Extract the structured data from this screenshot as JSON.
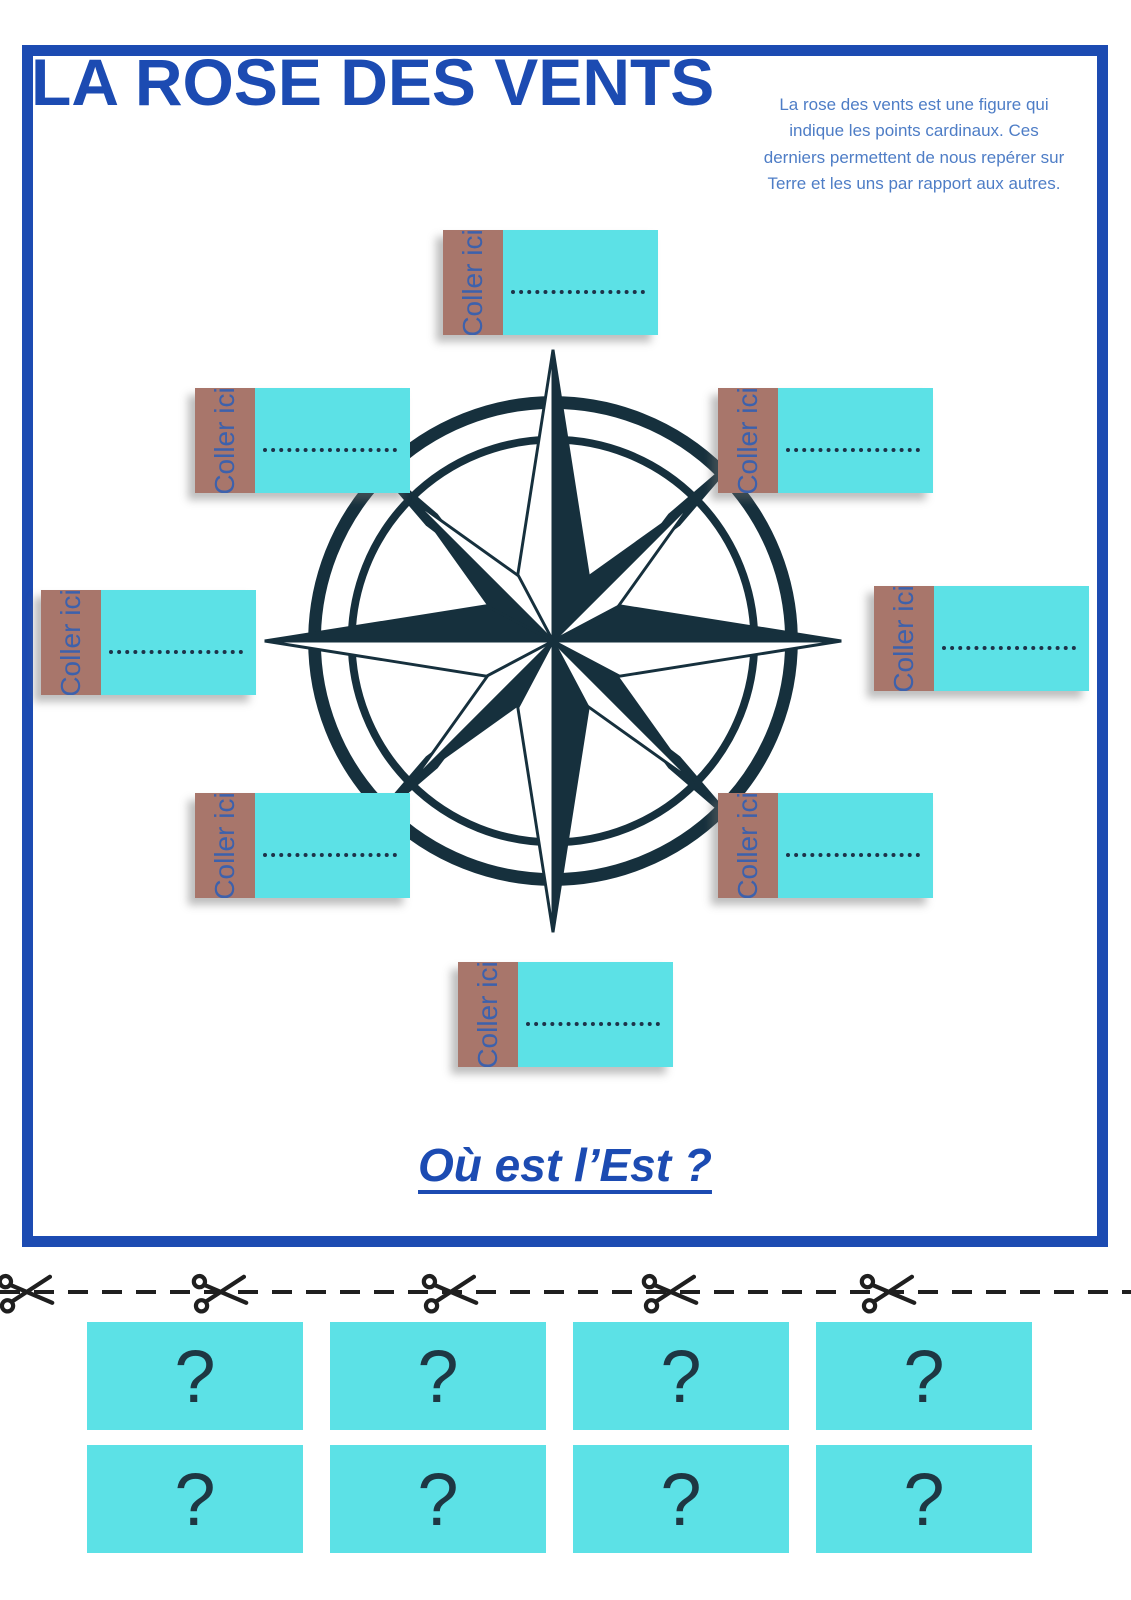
{
  "header": {
    "title": "LA ROSE DES VENTS",
    "intro": "La rose des vents est une figure qui indique les points cardinaux. Ces derniers permettent de nous repérer sur Terre et les uns par rapport aux autres."
  },
  "compass": {
    "name": "compass-rose"
  },
  "paste_cards": [
    {
      "position": "north",
      "label": "Coller ici"
    },
    {
      "position": "north-west",
      "label": "Coller ici"
    },
    {
      "position": "north-east",
      "label": "Coller ici"
    },
    {
      "position": "west",
      "label": "Coller ici"
    },
    {
      "position": "east",
      "label": "Coller ici"
    },
    {
      "position": "south-west",
      "label": "Coller ici"
    },
    {
      "position": "south-east",
      "label": "Coller ici"
    },
    {
      "position": "south",
      "label": "Coller ici"
    }
  ],
  "question": {
    "text": "Où est l’Est ?"
  },
  "cutout": {
    "scissors_count": 5,
    "answer_cards": [
      "?",
      "?",
      "?",
      "?",
      "?",
      "?",
      "?",
      "?"
    ]
  },
  "colors": {
    "frame_blue": "#1c4bb2",
    "title_blue": "#1c4bb2",
    "intro_blue": "#4e7dc6",
    "cyan": "#5ce1e6",
    "brown": "#a8766b",
    "label_blue": "#3d61ac",
    "compass_dark": "#16303d",
    "dots_ink": "#1d3349",
    "scissors_ink": "#1f1f1f"
  }
}
